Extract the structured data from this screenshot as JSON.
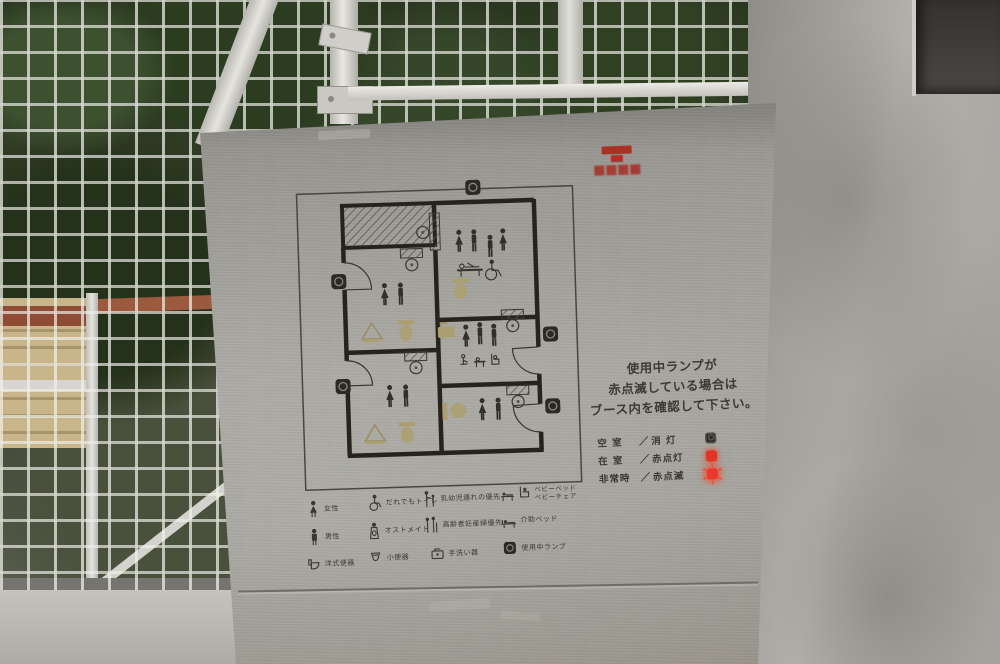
{
  "colors": {
    "steel": "#9b9993",
    "accent_red": "#a93126",
    "lamp_red": "#e8392b",
    "plan_line": "#26231d",
    "engraving_gold": "#ab9f72",
    "text_dark": "#3b3934"
  },
  "sign": {
    "emblem": {
      "icon": "red-emblem",
      "color": "#a93126"
    },
    "notice": {
      "lines": [
        "使用中ランプが",
        "赤点滅している場合は",
        "ブース内を確認して下さい。"
      ]
    },
    "lamp_legend": {
      "separator": "／",
      "rows": [
        {
          "label": "空 室",
          "state": "消 灯",
          "lamp": "off"
        },
        {
          "label": "在 室",
          "state": "赤点灯",
          "lamp": "on"
        },
        {
          "label": "非常時",
          "state": "赤点滅",
          "lamp": "blink"
        }
      ]
    },
    "icon_legend": {
      "rows": [
        {
          "items": [
            {
              "icon": "female-icon",
              "label": "女性"
            },
            {
              "icon": "wheelchair-icon",
              "label": "だれでもトイレ"
            },
            {
              "icon": "parent-child-icon",
              "label": "乳幼児連れの優先"
            },
            {
              "icon": "baby-bed-chair-icon",
              "label": "ベビーベッド",
              "label2": "ベビーチェア"
            }
          ]
        },
        {
          "items": [
            {
              "icon": "male-icon",
              "label": "男性"
            },
            {
              "icon": "ostomate-icon",
              "label": "オストメイト"
            },
            {
              "icon": "elderly-priority-icon",
              "label": "高齢者妊産婦優先"
            },
            {
              "icon": "nursing-bed-icon",
              "label": "介助ベッド"
            }
          ]
        },
        {
          "items": [
            {
              "icon": "western-toilet-icon",
              "label": "洋式便器"
            },
            {
              "icon": "urinal-icon",
              "label": "小便器"
            },
            {
              "icon": "hand-wash-icon",
              "label": "手洗い器"
            },
            {
              "icon": "in-use-lamp-icon",
              "label": "使用中ランプ"
            }
          ]
        }
      ]
    },
    "floorplan": {
      "rooms": [
        {
          "id": "service-area-hatched",
          "icons": []
        },
        {
          "id": "booth-left-upper",
          "icons": [
            "female",
            "male",
            "washbasin",
            "toilet"
          ]
        },
        {
          "id": "booth-left-lower",
          "icons": [
            "female",
            "male",
            "washbasin",
            "toilet"
          ]
        },
        {
          "id": "accessible-room",
          "icons": [
            "female",
            "male",
            "child",
            "female",
            "baby-bed",
            "wheelchair",
            "toilet"
          ]
        },
        {
          "id": "booth-right-middle",
          "icons": [
            "hand-wash",
            "female",
            "male",
            "male",
            "baby-care",
            "baby-bed",
            "baby-chair"
          ]
        },
        {
          "id": "booth-right-lower",
          "icons": [
            "toilet",
            "female",
            "male"
          ]
        }
      ],
      "lamp_positions": [
        "top-center",
        "left-upper",
        "left-lower",
        "right-upper",
        "right-lower"
      ]
    }
  }
}
